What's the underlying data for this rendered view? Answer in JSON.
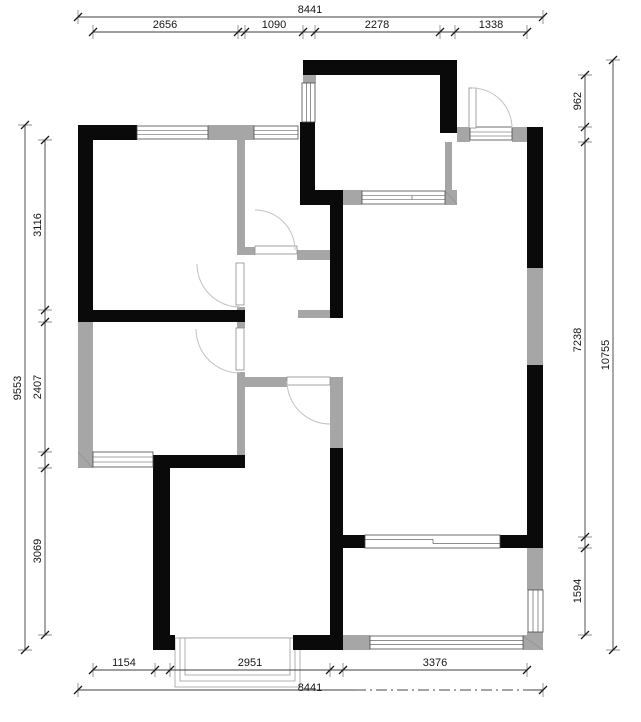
{
  "drawing": {
    "type": "floor-plan",
    "colors": {
      "wall": "#0a0a0a",
      "light_wall": "#a6a6a6",
      "dim_line": "#3f3f3f",
      "text": "#161616"
    },
    "dimensions": {
      "top": {
        "total": "8441",
        "segments": [
          "2656",
          "1090",
          "2278",
          "1338"
        ]
      },
      "left": {
        "total": "9553",
        "segments": [
          "3116",
          "2407",
          "3069"
        ]
      },
      "right": {
        "total": "10755",
        "segments": [
          "962",
          "7238",
          "1594"
        ]
      },
      "bottom": {
        "total": "8441",
        "segments": [
          "1154",
          "2951",
          "3376"
        ]
      }
    }
  }
}
